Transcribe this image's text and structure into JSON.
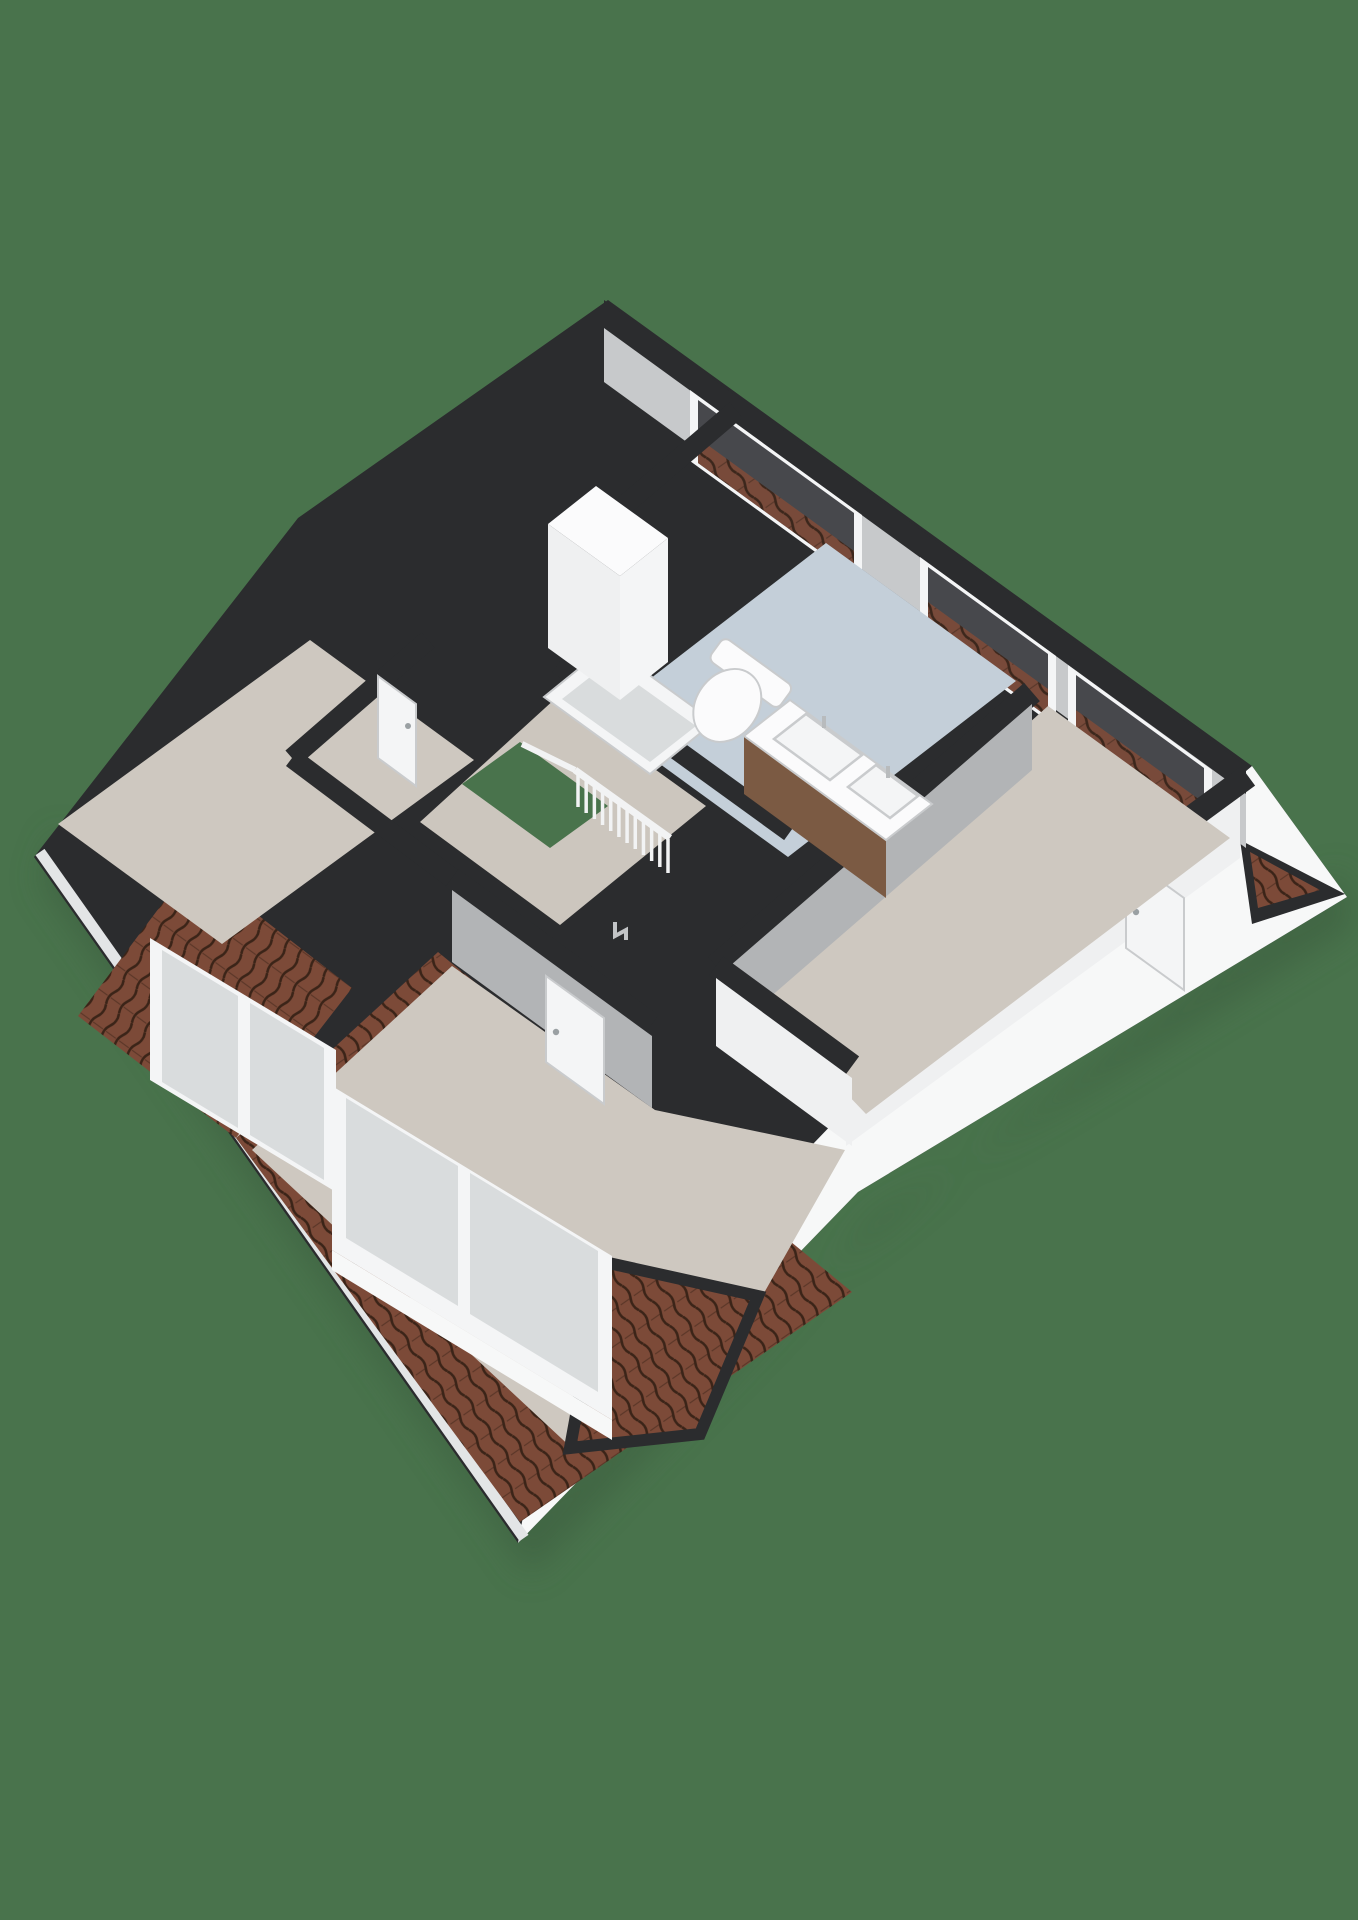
{
  "scene": {
    "kind": "3d-floorplan-render",
    "view": "isometric-top",
    "storey": "attic-floor",
    "visible_text": ""
  },
  "colors": {
    "background": "#49734C",
    "charcoal": "#2B2C2E",
    "charcoal_soft": "#3A3B3E",
    "facade_white": "#F7F8F8",
    "gutter": "#E3E5E6",
    "roof_tile_base": "#7C4A38",
    "roof_tile_line": "#3B2418",
    "ne_wall_face": "#C7C9CB",
    "wall_face_light": "#EFF0F1",
    "wall_face_shadow": "#B2B4B6",
    "floor_beige": "#CEC8C0",
    "floor_hall": "#CCC6BE",
    "floor_blue": "#C4CFD9",
    "glass_dark": "#47484C",
    "glass_light": "#D9DCDD",
    "frame_white": "#F4F5F6",
    "fixture_white": "#FBFBFC",
    "fixture_edge": "#C9CBCD",
    "wood_cabinet": "#7B5A43",
    "rail_white": "#F2F3F4",
    "shadow_green": "#3A5C3E"
  },
  "inventory": {
    "roof_wall_windows": 3,
    "dormer_windows": 2,
    "dormer_panes_each": 2,
    "skylights": 1,
    "doors": 3,
    "toilets": 1,
    "vanity_basins": 2,
    "stair_openings": 1,
    "roof_valley_notches": 1
  },
  "railing": {
    "balusters": 12,
    "height_px": 34
  }
}
